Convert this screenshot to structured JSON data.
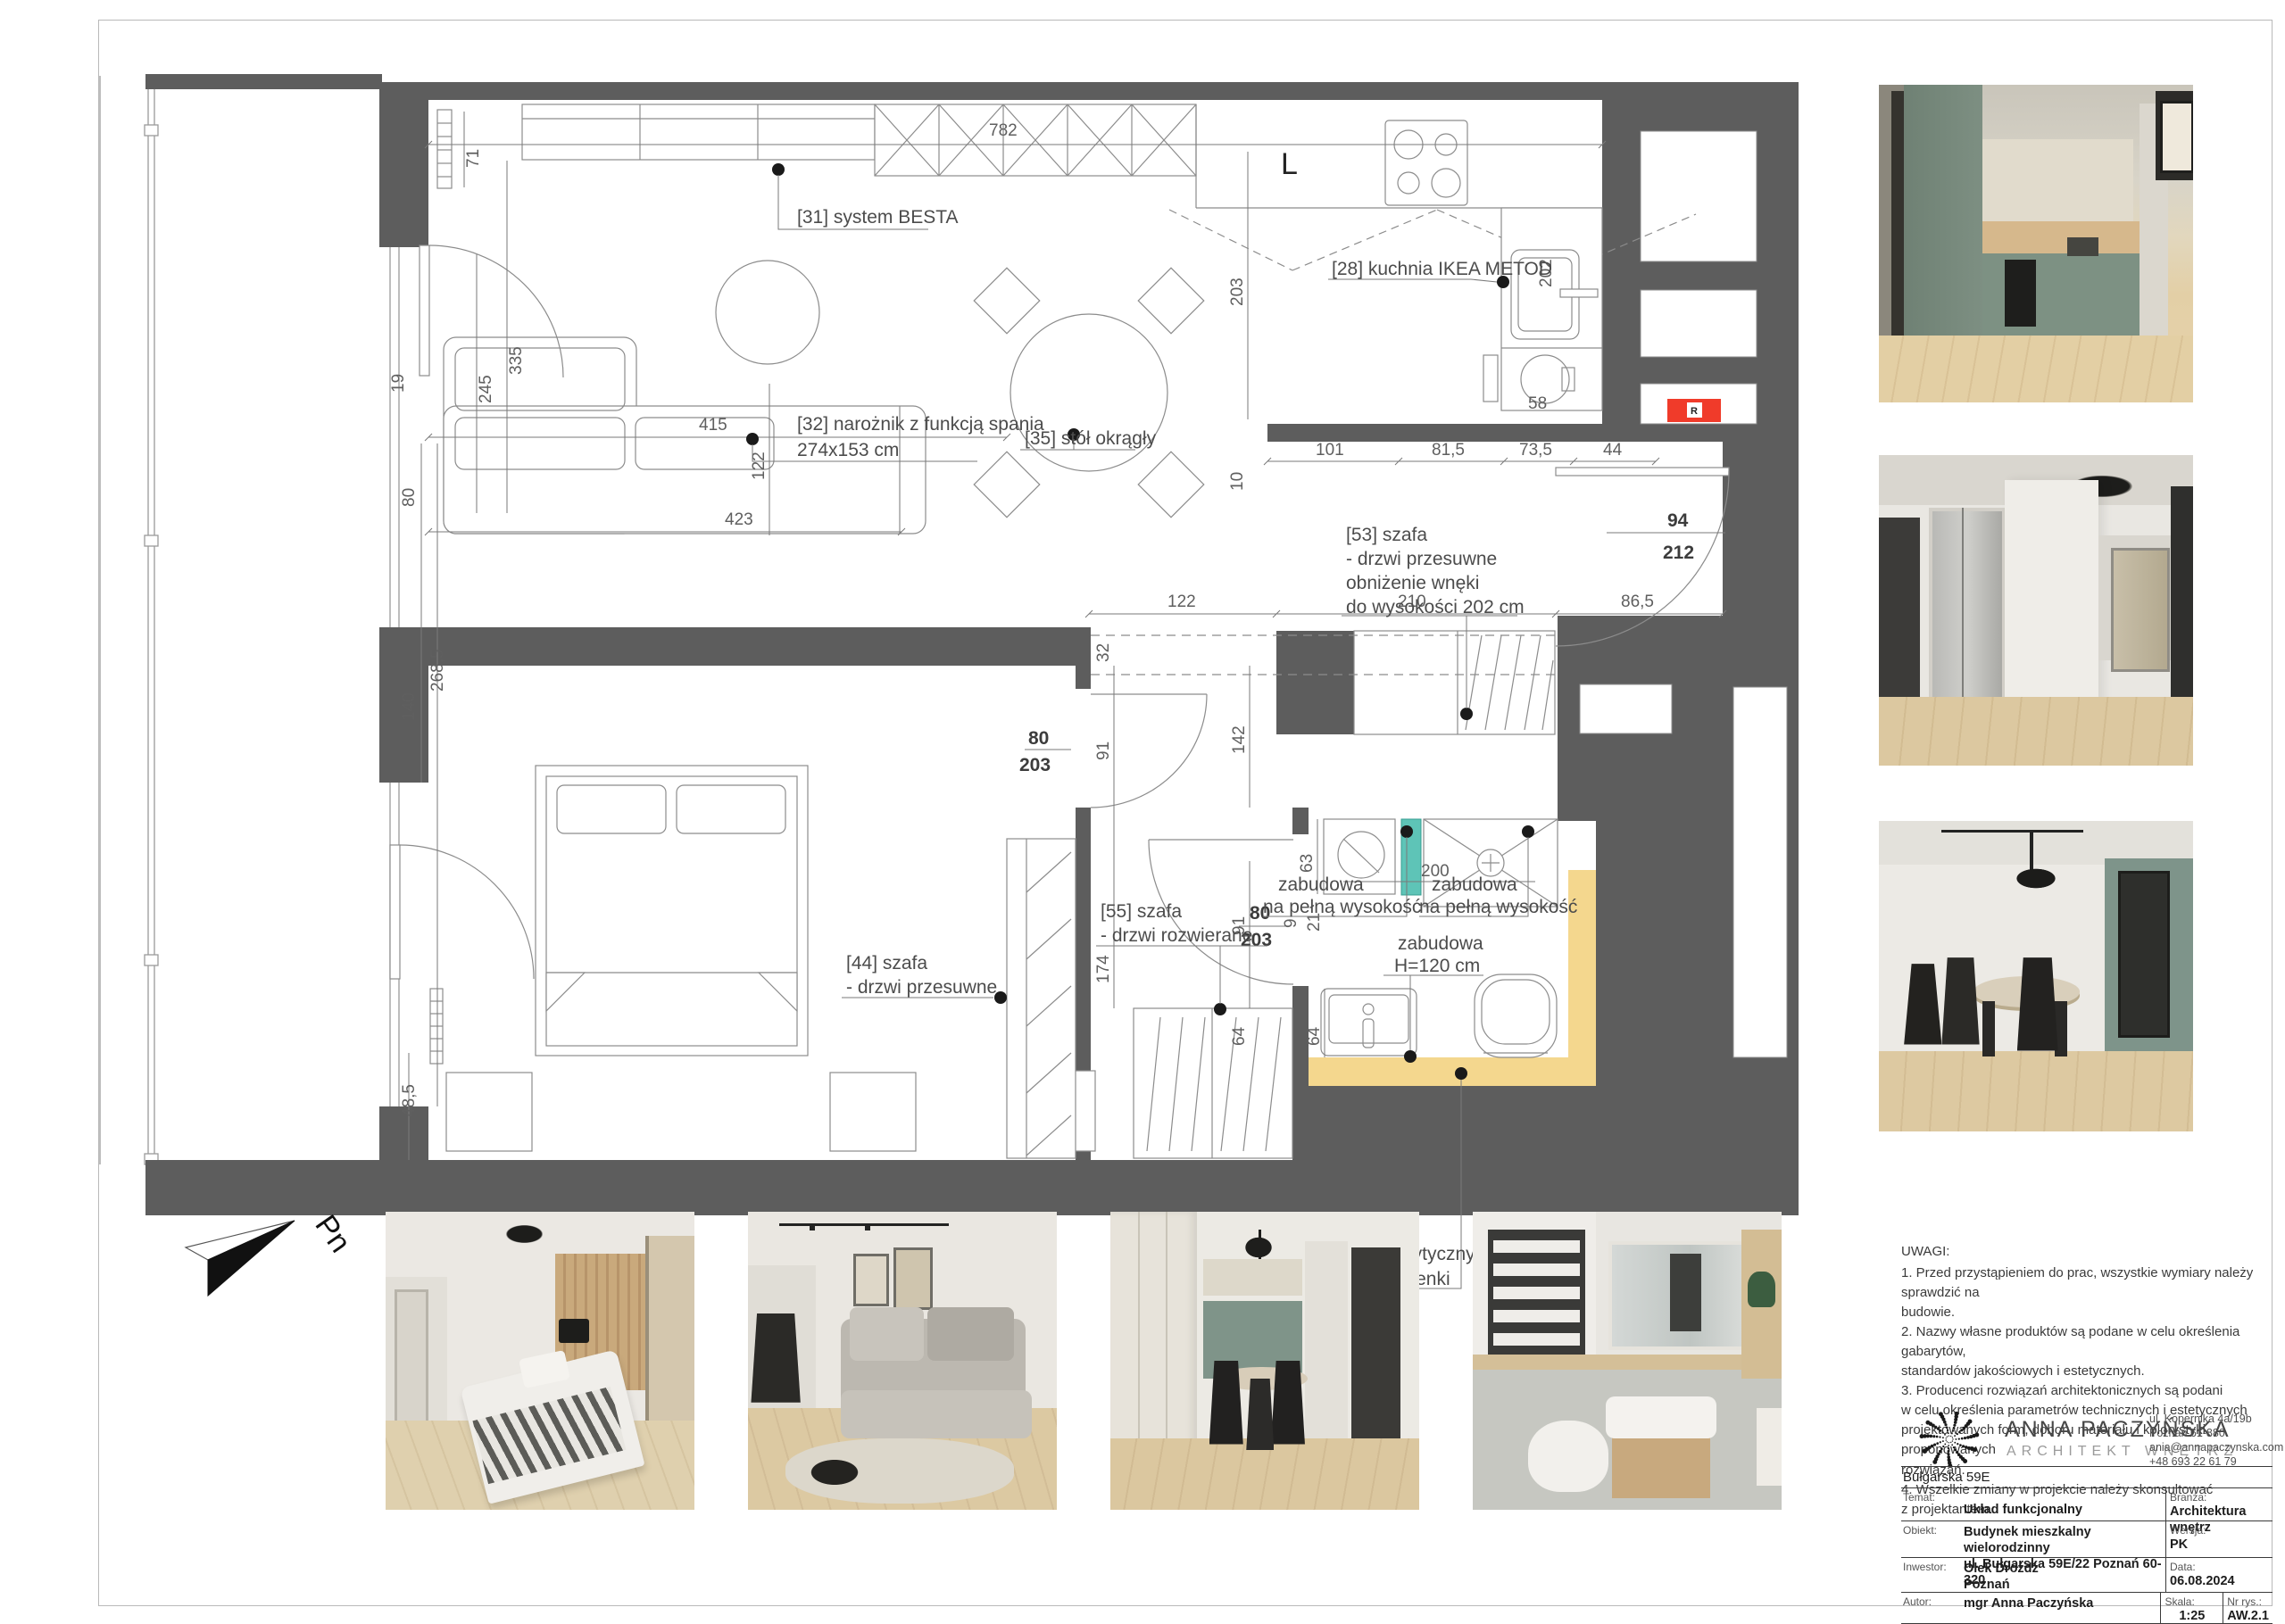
{
  "plan": {
    "labels": {
      "l31": "[31] system BESTA",
      "l28": "[28] kuchnia IKEA METOD",
      "l32a": "[32] narożnik z funkcją spania",
      "l32b": "274x153 cm",
      "l35": "[35] stół okrągły",
      "l53a": "[53] szafa",
      "l53b": "- drzwi przesuwne",
      "l53c": "obniżenie wnęki",
      "l53d": "do wysokości 202 cm",
      "l55a": "[55] szafa",
      "l55b": "- drzwi rozwierane",
      "l44a": "[44] szafa",
      "l44b": "- drzwi przesuwne",
      "zab1a": "zabudowa",
      "zab1b": "na pełną wysokość",
      "zab2a": "zabudowa",
      "zab2b": "na pełną wysokość",
      "zab3a": "zabudowa",
      "zab3b": "H=120 cm",
      "ceil1": "obniżenie sufitu zgodnie z wytycznymi",
      "ceil2": "na rysunku kładów ścian łazienki",
      "hood": "L",
      "elec": "R",
      "north": "Pn"
    },
    "dims": {
      "d782": "782",
      "d71": "71",
      "d335": "335",
      "d245": "245",
      "d19": "19",
      "d423": "423",
      "d122v": "122",
      "d203v": "203",
      "d10": "10",
      "d101": "101",
      "d815": "81,5",
      "d735": "73,5",
      "d44": "44",
      "d58": "58",
      "d202": "202",
      "d94": "94",
      "d212": "212",
      "d865": "86,5",
      "d210": "210",
      "d122h": "122",
      "d32": "32",
      "d91a": "91",
      "d142": "142",
      "d80a": "80",
      "d203a": "203",
      "d174": "174",
      "d91b": "91",
      "d80b": "80",
      "d203b": "203",
      "d63": "63",
      "d9": "9",
      "d21": "21",
      "d200": "200",
      "d64a": "64",
      "d64b": "64",
      "d415": "415",
      "d80c": "80",
      "d140": "140",
      "d2685": "268,5",
      "d485": "48,5"
    },
    "colors": {
      "wall": "#5d5d5d",
      "teal": "#5ec4b7",
      "tan": "#f4d78e",
      "red": "#f03b2a"
    }
  },
  "notes": {
    "title": "UWAGI:",
    "lines": [
      "1. Przed przystąpieniem do prac, wszystkie wymiary należy sprawdzić na",
      "budowie.",
      "2. Nazwy własne produktów są podane w celu określenia gabarytów,",
      "standardów jakościowych i estetycznych.",
      "3. Producenci rozwiązań architektonicznych są podani",
      "w celu określenia parametrów technicznych i estetycznych",
      "projektowanych form, doboru materiału i kolorystyki proponowanych",
      "rozwiązań.",
      "4. Wszelkie zmiany w projekcie należy skonsultować",
      "z projektantem."
    ]
  },
  "brand": {
    "name": "ANNA PACZYŃSKA",
    "subtitle": "ARCHITEKT WNĘTRZ",
    "address1": "ul. Kopernika 4a/19b",
    "address2": "Poznań 61-880",
    "email": "ania@annapaczynska.com",
    "phone": "+48 693 22 61 79"
  },
  "titleblock": {
    "project": "Bułgarska 59E",
    "temat_label": "Temat:",
    "temat": "Układ funkcjonalny",
    "branza_label": "Branża:",
    "branza": "Architektura wnętrz",
    "obiekt_label": "Obiekt:",
    "obiekt1": "Budynek mieszkalny wielorodzinny",
    "obiekt2": "ul. Bułgarska 59E/22 Poznań 60-320",
    "wersja_label": "Wersja:",
    "wersja": "PK",
    "inwestor_label": "Inwestor:",
    "inwestor1": "Olek  Drożdż",
    "inwestor2": "Poznań",
    "data_label": "Data:",
    "data": "06.08.2024",
    "autor_label": "Autor:",
    "autor": "mgr Anna Paczyńska",
    "skala_label": "Skala:",
    "skala": "1:25",
    "nr_label": "Nr rys.:",
    "nr": "AW.2.1"
  },
  "photos": {
    "right": [
      "kitchen-render",
      "hallway-render",
      "dining-render"
    ],
    "bottom": [
      "bedroom-render",
      "living-room-render",
      "dining-kitchen-render",
      "bathroom-render"
    ]
  }
}
